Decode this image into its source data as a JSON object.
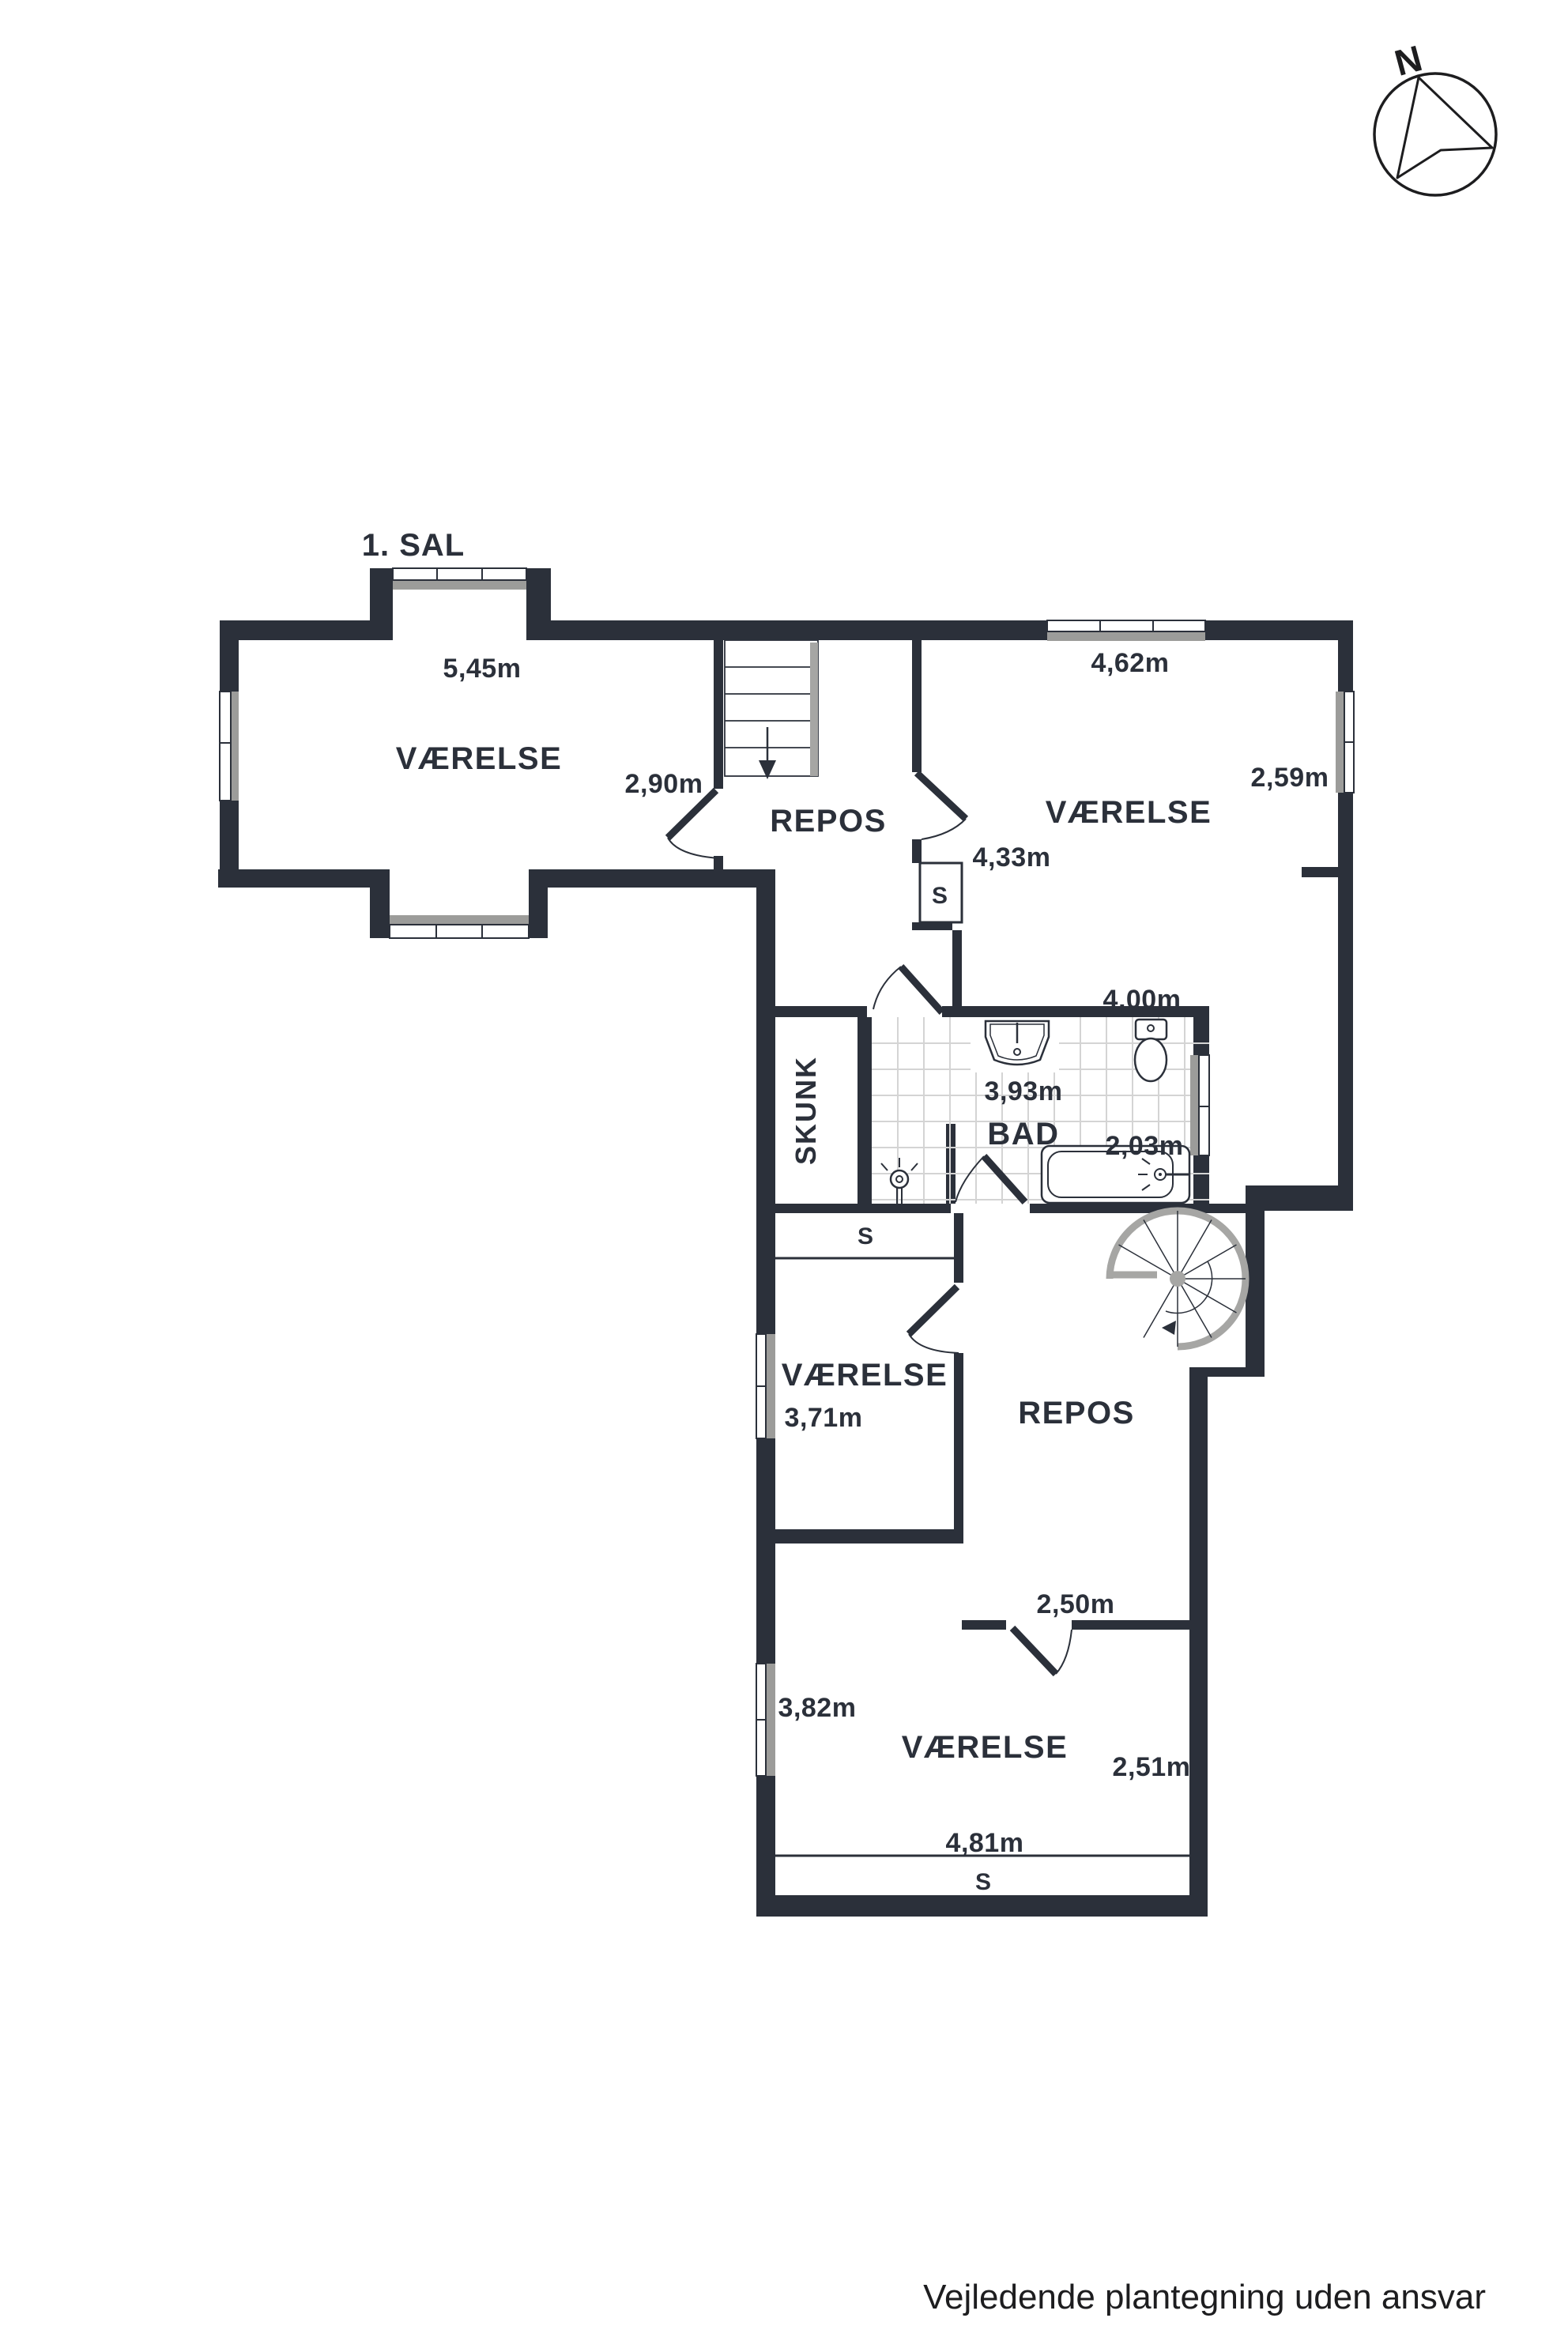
{
  "page": {
    "title": "1. SAL",
    "disclaimer": "Vejledende plantegning uden ansvar"
  },
  "compass": {
    "north_label": "N"
  },
  "colors": {
    "wall": "#2b303a",
    "sill": "#9c9c9a",
    "stair_rail": "#a6a6a4",
    "tile_line": "#d4d4d4"
  },
  "rooms": {
    "nw": {
      "name": "VÆRELSE",
      "dim_width": "5,45m",
      "dim_door": "2,90m"
    },
    "repos_top": {
      "name": "REPOS"
    },
    "ne": {
      "name": "VÆRELSE",
      "dim_width": "4,62m",
      "dim_height": "2,59m",
      "dim_bottom": "4,33m",
      "closet": "S"
    },
    "bad": {
      "name": "BAD",
      "dim_width_top": "4,00m",
      "dim_width": "3,93m",
      "dim_height": "2,03m"
    },
    "skunk": {
      "name": "SKUNK",
      "closet": "S"
    },
    "mid": {
      "name": "VÆRELSE",
      "dim_width": "3,71m"
    },
    "repos_mid": {
      "name": "REPOS",
      "dim_door": "2,50m"
    },
    "south": {
      "name": "VÆRELSE",
      "dim_left": "3,82m",
      "dim_right": "2,51m",
      "dim_width": "4,81m",
      "closet": "S"
    }
  }
}
